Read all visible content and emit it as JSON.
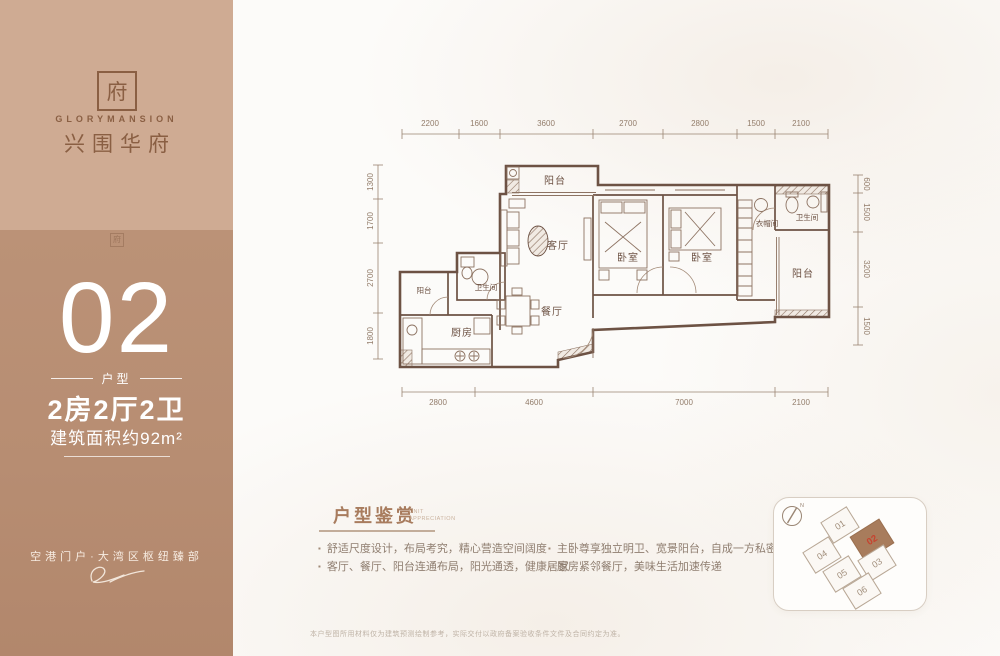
{
  "sidebar": {
    "logo": {
      "seal_glyph": "府",
      "brand_en": "GLORYMANSION",
      "brand_cn": "兴围华府"
    },
    "watermark_glyph": "府",
    "unit_number": "02",
    "unit_label": "户型",
    "layout": "2房2厅2卫",
    "area": "建筑面积约92m²",
    "slogan": "空港门户·大湾区枢纽臻部"
  },
  "plan": {
    "dims_top": [
      "2200",
      "1600",
      "3600",
      "2700",
      "2800",
      "1500",
      "2100"
    ],
    "dims_bottom": [
      "2800",
      "4600",
      "7000",
      "2100"
    ],
    "dims_left": [
      "1300",
      "1700",
      "2700",
      "1800"
    ],
    "dims_right": [
      "600",
      "1500",
      "3200",
      "1500"
    ],
    "rooms": {
      "balcony_top": "阳台",
      "living": "客厅",
      "dining": "餐厅",
      "kitchen": "厨房",
      "balcony_kitchen": "阳台",
      "bath_guest": "卫生间",
      "bedroom1": "卧室",
      "bedroom2": "卧室",
      "cloakroom": "衣帽间",
      "bath_master": "卫生间",
      "balcony_master": "阳台"
    }
  },
  "appreciation": {
    "title": "户型鉴赏",
    "subtitle_line1": "UNIT",
    "subtitle_line2": "APPRECIATION",
    "bullets_left": [
      "舒适尺度设计，布局考究，精心营造空间阔度",
      "客厅、餐厅、阳台连通布局，阳光通透，健康居家"
    ],
    "bullets_right": [
      "主卧尊享独立明卫、宽景阳台，自成一方私密天地",
      "厨房紧邻餐厅，美味生活加速传递"
    ],
    "disclaimer": "本户型图所用材料仅为建筑预测绘制参考，实际交付以政府备案验收条件文件及合同约定为准。"
  },
  "sitemap": {
    "compass": "N",
    "units": [
      {
        "id": "01"
      },
      {
        "id": "02"
      },
      {
        "id": "03"
      },
      {
        "id": "04"
      },
      {
        "id": "05"
      },
      {
        "id": "06"
      }
    ],
    "highlighted_unit": "02"
  },
  "colors": {
    "sidebar_top": "#cfab93",
    "sidebar_bottom": "#b78d72",
    "brand_brown": "#8a5f43",
    "plan_line": "#6d5244",
    "highlight_fill": "#a87c5c",
    "highlight_text": "#c6432f"
  }
}
